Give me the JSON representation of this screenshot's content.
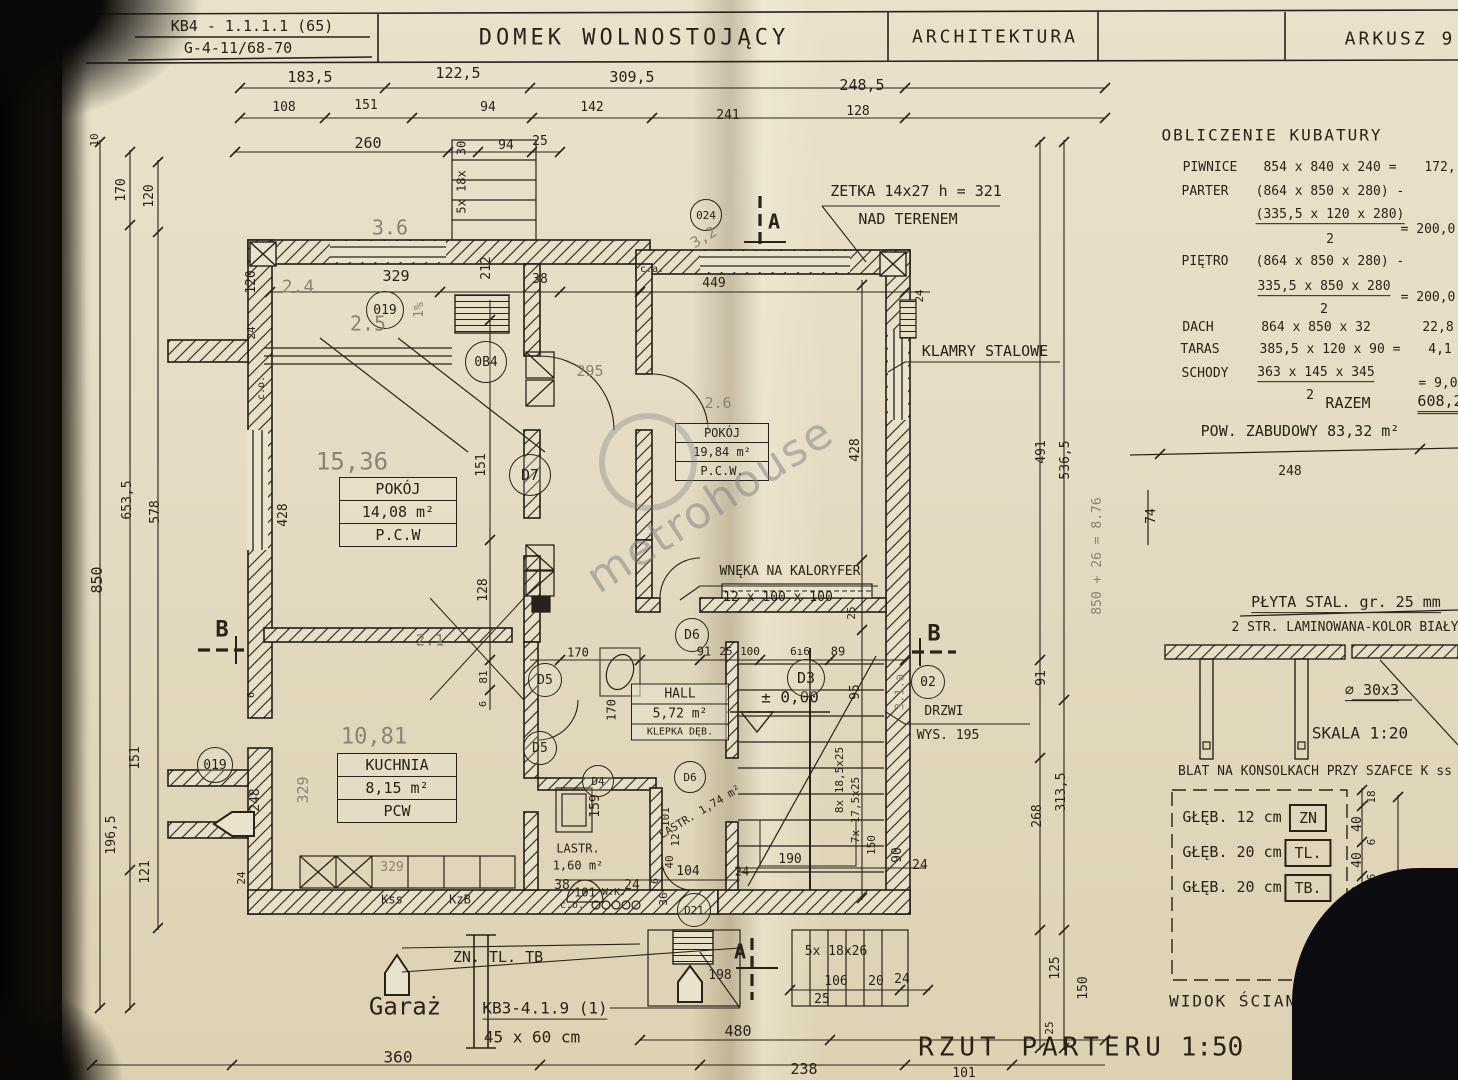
{
  "header": {
    "code1": "KB4 - 1.1.1.1 (65)",
    "code2": "G-4-11/68-70",
    "title": "DOMEK WOLNOSTOJĄCY",
    "discipline": "ARCHITEKTURA",
    "sheet": "ARKUSZ 9"
  },
  "kubatura": {
    "title": "OBLICZENIE KUBATURY",
    "piwnice_label": "PIWNICE",
    "piwnice_expr": "854 x 840 x 240  =",
    "piwnice_res": "172,",
    "parter_label": "PARTER",
    "parter_expr": "(864 x 850 x 280) -",
    "parter_num": "(335,5 x 120 x 280)",
    "parter_den": "2",
    "parter_res": "= 200,0",
    "pietro_label": "PIĘTRO",
    "pietro_expr": "(864 x 850 x 280) -",
    "pietro_num": "335,5 x 850 x 280",
    "pietro_den": "2",
    "pietro_res": "= 200,0",
    "dach_label": "DACH",
    "dach_expr": "864 x 850 x 32",
    "dach_res": "22,8",
    "taras_label": "TARAS",
    "taras_expr": "385,5 x 120 x 90  =",
    "taras_res": "4,1",
    "schody_label": "SCHODY",
    "schody_num": "363 x 145 x 345",
    "schody_den": "2",
    "schody_res": "=  9,0",
    "razem_label": "RAZEM",
    "razem_res": "608,2",
    "pow": "POW. ZABUDOWY  83,32 m²"
  },
  "details": {
    "plyta1": "PŁYTA STAL. gr. 25 mm",
    "plyta2": "2 STR. LAMINOWANA-KOLOR BIAŁY",
    "fi": "⌀ 30x3",
    "skala": "SKALA  1:20",
    "blat": "BLAT NA KONSOLKACH PRZY SZAFCE K ss",
    "g1": "GŁĘB. 12 cm",
    "g1_tag": "ZN",
    "g2": "GŁĘB. 20 cm",
    "g2_tag": "TL.",
    "g3": "GŁĘB. 20 cm",
    "g3_tag": "TB.",
    "widok": "WIDOK ŚCIANY Z WN",
    "dims": [
      "248",
      "74",
      "18",
      "40",
      "6",
      "40",
      "6",
      "40",
      "100",
      "250"
    ]
  },
  "rooms": {
    "pokoj1": {
      "name": "POKÓJ",
      "area": "14,08 m²",
      "floor": "P.C.W"
    },
    "pokoj2": {
      "name": "POKÓJ",
      "area": "19,84 m²",
      "floor": "P.C.W."
    },
    "kuchnia": {
      "name": "KUCHNIA",
      "area": "8,15 m²",
      "floor": "PCW"
    },
    "hall": {
      "name": "HALL",
      "area": "5,72 m²",
      "floor": "KLEPKA DĘB."
    },
    "lastr1a": "LASTR.",
    "lastr1b": "1,60 m²",
    "lastr2": "LASTR. 1,74 m²",
    "garaz": "Garaż"
  },
  "notes": {
    "zetka1": "ZETKA 14x27 h = 321",
    "zetka2": "NAD TERENEM",
    "klamry": "KLAMRY STALOWE",
    "wneka1": "WNĘKA NA KALORYFER",
    "wneka2": "12 x 100 x 100",
    "drzwi1": "DRZWI",
    "drzwi2": "WYS. 195",
    "level": "± 0,00",
    "wk": "W.K.",
    "co1": "c.o.",
    "co2": "c.o.",
    "ca": "c.a.",
    "zntltb": "ZN. TL. TB",
    "kb3a": "KB3-4.1.9 (1)",
    "kb3b": "45 x 60 cm",
    "kss": "Kss",
    "kzb": "KzB",
    "plan_title": "RZUT PARTERU",
    "plan_scale": "1:50"
  },
  "circles": {
    "o19a": "019",
    "o19b": "019",
    "ob4": "0B4",
    "o24": "024",
    "o2": "02",
    "d7": "D7",
    "d5a": "D5",
    "d5b": "D5",
    "d4": "D4",
    "d6a": "D6",
    "d6b": "D6",
    "d3": "D3",
    "d21": "D21",
    "arch": "101"
  },
  "sections": {
    "a": "A",
    "b": "B"
  },
  "dims": {
    "top1": [
      "183,5",
      "122,5",
      "309,5",
      "248,5"
    ],
    "top2": [
      "108",
      "151",
      "94",
      "142",
      "241",
      "128"
    ],
    "top3": [
      "260",
      "30",
      "94",
      "25"
    ],
    "top_stairs": "5x 18x",
    "left": [
      "10",
      "170",
      "120",
      "653,5",
      "578",
      "850",
      "428",
      "151",
      "196,5",
      "121",
      "24",
      "248",
      "6",
      "24",
      "120"
    ],
    "inner": [
      "329",
      "212",
      "38",
      "449",
      "24",
      "151",
      "128",
      "81",
      "6",
      "170",
      "170",
      "91",
      "25",
      "100",
      "6ı6",
      "89",
      "95",
      "428",
      "25",
      "8x 18,5x25",
      "7x 17,5x25",
      "150",
      "90",
      "190",
      "24",
      "24",
      "104",
      "36",
      "40",
      "12",
      "159",
      "101",
      "38",
      "24",
      "6"
    ],
    "right": [
      "491",
      "536,5",
      "91",
      "268",
      "313,5",
      "125",
      "150",
      "25"
    ],
    "bottom": [
      "360",
      "480",
      "238",
      "101",
      "106",
      "20",
      "24",
      "25",
      "198",
      "5x 18x26"
    ]
  },
  "pencil": {
    "a": "15,36",
    "b": "10,81",
    "c": "3.6",
    "d": "3,2",
    "e": "2.4",
    "f": "2.5",
    "g": "1%",
    "h": "2.1",
    "i": "329",
    "j": "295",
    "k": "3.1.a",
    "l": "850 + 26 = 8.76",
    "m": "2.6",
    "n": "329"
  },
  "watermark": "metrohouse"
}
